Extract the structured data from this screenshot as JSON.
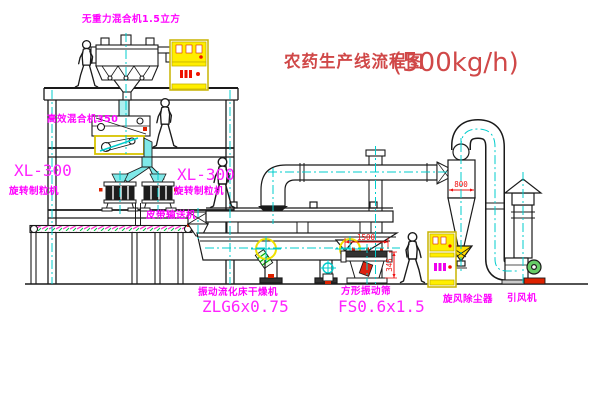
{
  "title": {
    "text": "农药生产线流程图",
    "capacity": "(500kg/h)"
  },
  "labels": {
    "gravity_mixer": "无重力混合机1.5立方",
    "high_speed_mixer": "高效混合机350",
    "granulator_model_left": "XL-300",
    "granulator_model_right": "XL-300",
    "granulator_name_left": "旋转制粒机",
    "granulator_name_right": "旋转制粒机",
    "belt_conveyor": "皮带输送机",
    "dryer_name": "振动流化床干燥机",
    "dryer_model": "ZLG6x0.75",
    "sieve_name": "方形振动筛",
    "sieve_model": "FS0.6x1.5",
    "cyclone": "旋风除尘器",
    "fan": "引风机"
  },
  "dimensions": {
    "sieve_length": "1500",
    "sieve_height": "345",
    "cyclone_diameter": "800"
  },
  "colors": {
    "line": "#1a1a1a",
    "label_magenta": "#ff00ff",
    "title_red": "#d04848",
    "dim_red": "#ee1111",
    "centerline_cyan": "#00cccc",
    "chute_cyan": "#7fe8e8",
    "cabinet_yellow": "#ffee00",
    "highlight_yellow": "#f0e000",
    "motor_green": "#66cc66",
    "base_red": "#dd2200"
  }
}
